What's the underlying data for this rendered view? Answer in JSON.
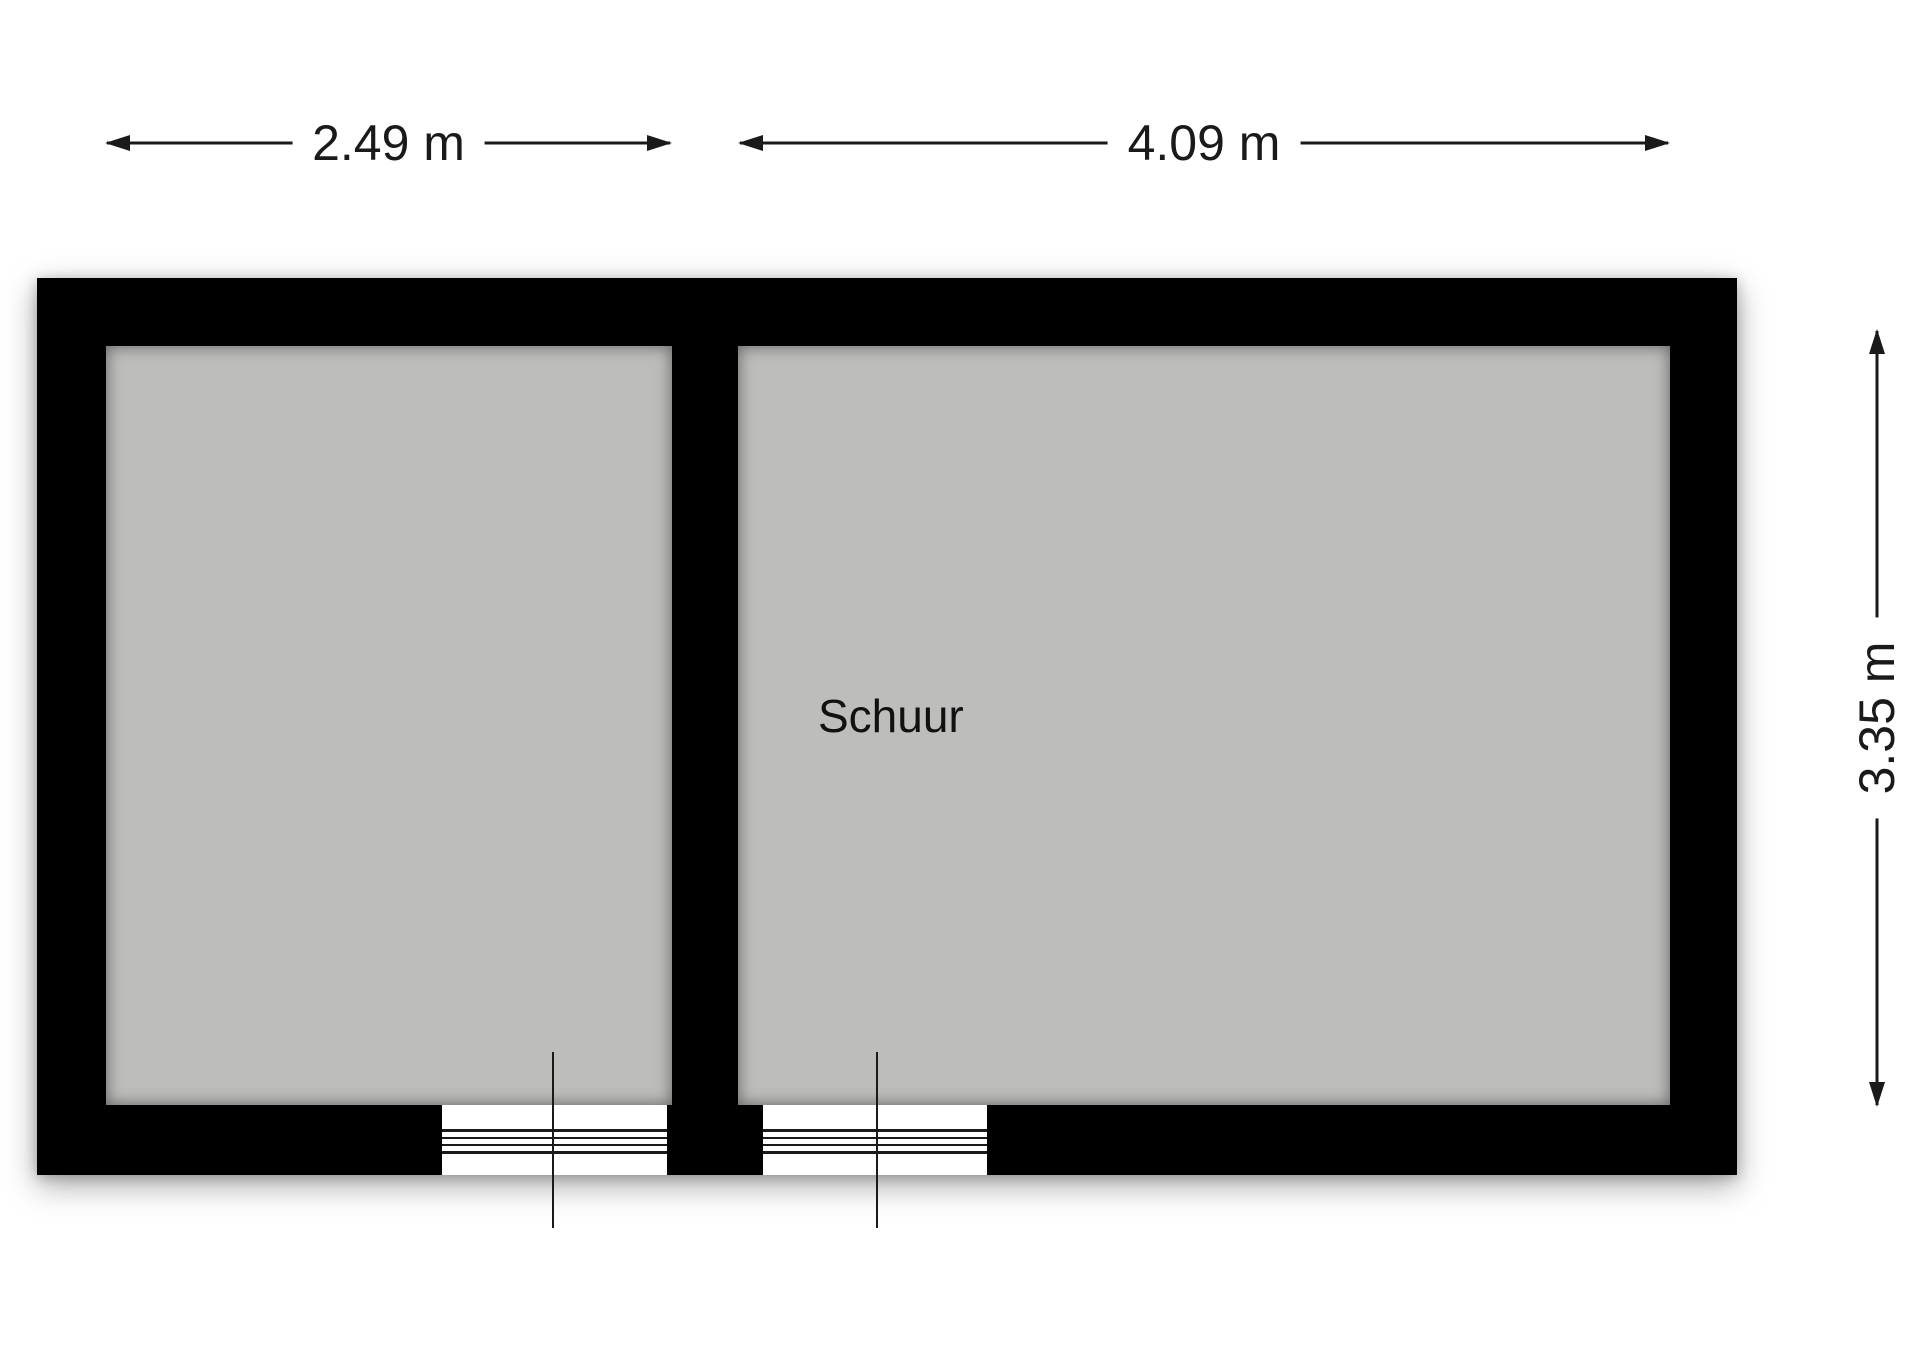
{
  "floorplan": {
    "rooms": [
      {
        "label": ""
      },
      {
        "label": "Schuur"
      }
    ],
    "dimensions": {
      "top_left": "2.49 m",
      "top_right": "4.09 m",
      "right_vertical": "3.35 m"
    },
    "colors": {
      "wall": "#000000",
      "floor": "#bdbdbb",
      "line": "#1a1a1a",
      "background": "#ffffff"
    }
  }
}
